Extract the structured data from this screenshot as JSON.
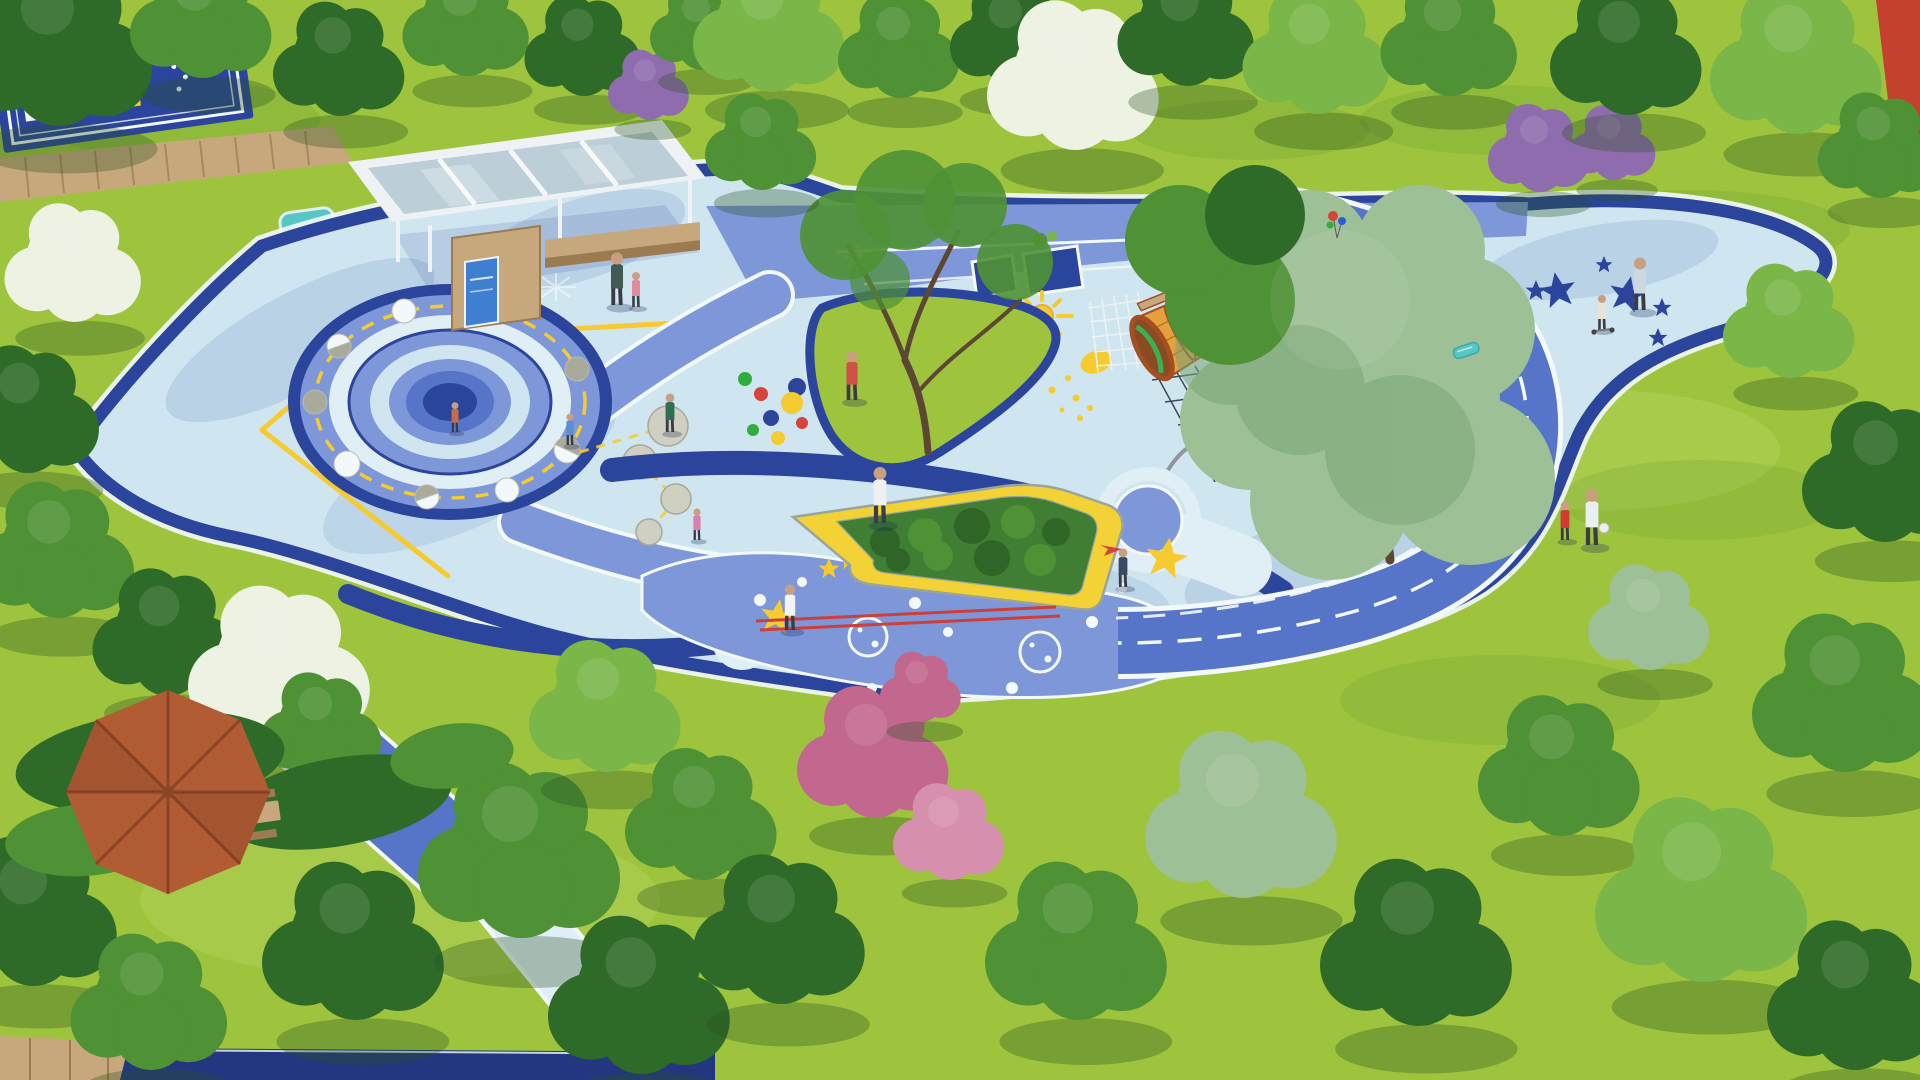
{
  "scene": {
    "alt": "Aerial 3D rendering of a space-themed children's playground park: blue rubber paving with planet mound, moon-phase stepping stones, yellow stars, sun and crescent graphics, a barrel telescope tunnel with climbing nets, a glass-roof pavilion, a blue running track, a yellow curved bench around a hedge, and a terracotta umbrella picnic corner, all surrounded by lawns and trees.",
    "width": 1920,
    "height": 1080
  },
  "palette": {
    "grass": "#9ec43e",
    "grassLight": "#b3d45c",
    "grassShade": "#6fa132",
    "treeDark": "#2f6b28",
    "treeMid": "#4f9135",
    "treeLight": "#7ab648",
    "treeSage": "#9dc096",
    "treeSageDark": "#7aa577",
    "blossomWhite": "#edf2e3",
    "blossomPink": "#c2688f",
    "blossomPinkLight": "#d78fae",
    "blossomPurple": "#8f6cae",
    "trunk": "#5c4733",
    "paveLight": "#cfe6f1",
    "paveLighter": "#e0eef6",
    "paveMid": "#7d97d8",
    "paveBlue": "#5674c8",
    "navy": "#2c459c",
    "navyDeep": "#22377f",
    "white": "#f3f8fb",
    "yellow": "#f6cb2f",
    "yellowDeep": "#e8a93a",
    "orange": "#e6a13c",
    "rimBrown": "#a34f22",
    "terracotta": "#b25c33",
    "wood": "#c7a87c",
    "woodDark": "#9c7b50",
    "glass": "#bccfd8",
    "teal": "#57c7c4",
    "red": "#d6423c",
    "dotGreen": "#2fae3e",
    "skin": "#c99f82",
    "stone": "#cfcfc2",
    "moonGray": "#a9a99c",
    "netDark": "#33383d",
    "hedge": "#3f7e33",
    "hedgeDark": "#2f6526",
    "benchYellow": "#f2d235",
    "trackRed": "#cf3f3a"
  },
  "features": {
    "game_court": "hopscotch game court",
    "boardwalk": "wooden boardwalk",
    "pond": "splash pond",
    "pavilion": "glass-roof pavilion with info kiosk",
    "moon_mound": "concentric-ring planet mound",
    "moon_phases": "moon-phase stepping stones on orbit ring",
    "orbit_line": "yellow dashed orbit line",
    "color_dots": "scattered color dots graphic",
    "crescent_moon": "yellow crescent moon graphic",
    "sun": "sun graphic with rays",
    "telescope_tunnel": "barrel telescope tunnel with climbing nets",
    "star_band": "star-studded walkway",
    "bubble_field": "planet-bubble paving graphic",
    "curved_bench": "yellow curved bench with hedge planter",
    "running_track": "blue running loop with dashed lanes",
    "star_plaza": "star plaza",
    "umbrella": "terracotta shade umbrella with picnic table",
    "figures_count": "14"
  }
}
